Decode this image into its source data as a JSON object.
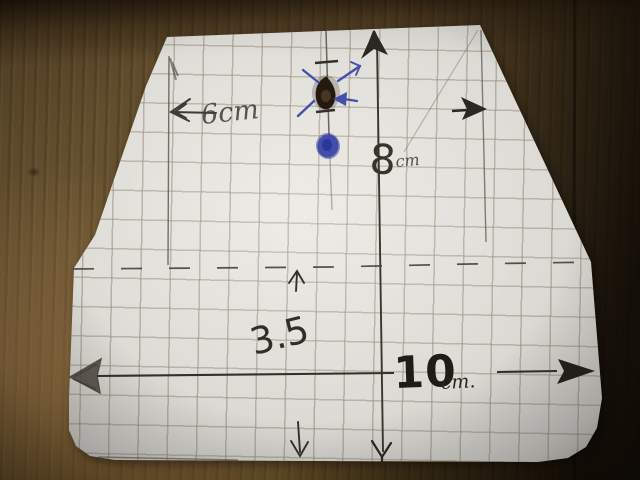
{
  "photo": {
    "subject": "Hand-drawn paper template on wooden table",
    "annotations": {
      "top_width_label": "6cm",
      "height_value": "8",
      "height_unit": "cm",
      "offset_label": "3.5",
      "bottom_width_value": "10",
      "bottom_width_unit": "cm."
    },
    "colors": {
      "paper": "#dcdad4",
      "grid_line": "#a79d8b",
      "pencil": "#433e35",
      "pencil_dark": "#262219",
      "ink_blue": "#4350ac",
      "wood_light": "#7d5f3b",
      "wood_mid": "#5d4729",
      "wood_dark": "#1c150c"
    }
  }
}
